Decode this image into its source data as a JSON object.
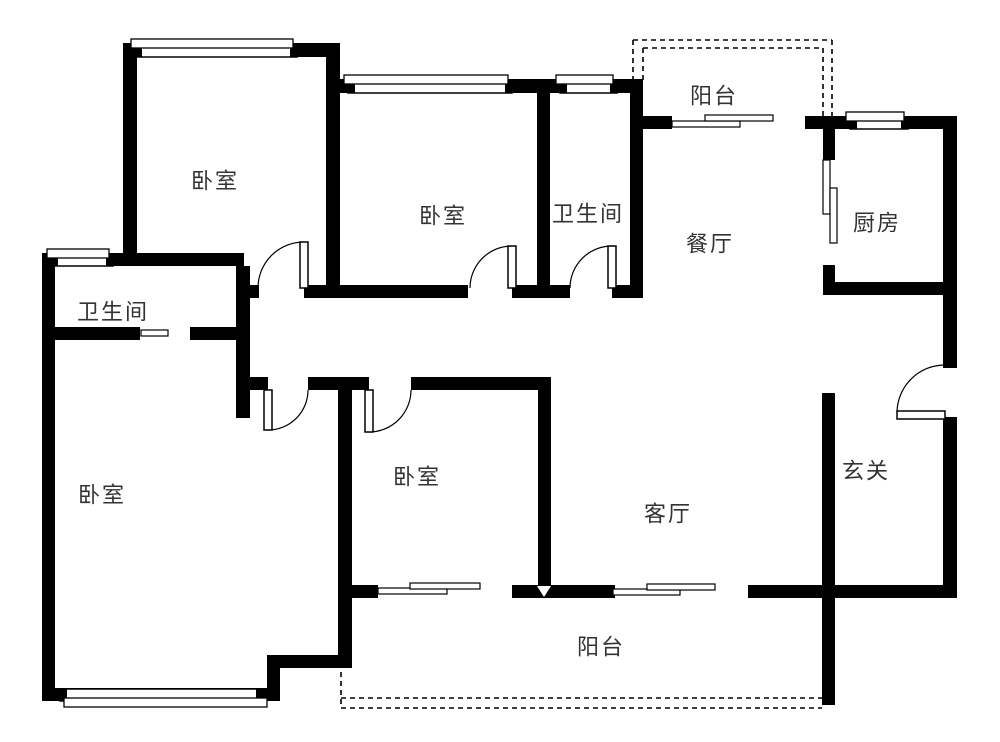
{
  "canvas": {
    "width": 1000,
    "height": 742,
    "bg": "#ffffff",
    "wall_color": "#000000",
    "line_color": "#000000",
    "label_color": "#333333",
    "label_font_size": 22,
    "label_letter_spacing": 2
  },
  "rooms": [
    {
      "id": "bedroom-top-left",
      "label": "卧室",
      "cx": 215,
      "cy": 181
    },
    {
      "id": "bedroom-top-middle",
      "label": "卧室",
      "cx": 443,
      "cy": 216
    },
    {
      "id": "bathroom-top",
      "label": "卫生间",
      "cx": 588,
      "cy": 214
    },
    {
      "id": "balcony-top",
      "label": "阳台",
      "cx": 714,
      "cy": 96
    },
    {
      "id": "dining-room",
      "label": "餐厅",
      "cx": 710,
      "cy": 244
    },
    {
      "id": "kitchen",
      "label": "厨房",
      "cx": 877,
      "cy": 223
    },
    {
      "id": "bathroom-left",
      "label": "卫生间",
      "cx": 113,
      "cy": 312
    },
    {
      "id": "bedroom-master",
      "label": "卧室",
      "cx": 102,
      "cy": 495
    },
    {
      "id": "bedroom-bottom-middle",
      "label": "卧室",
      "cx": 417,
      "cy": 477
    },
    {
      "id": "living-room",
      "label": "客厅",
      "cx": 668,
      "cy": 514
    },
    {
      "id": "entry-hall",
      "label": "玄关",
      "cx": 866,
      "cy": 471
    },
    {
      "id": "balcony-bottom",
      "label": "阳台",
      "cx": 601,
      "cy": 647
    }
  ],
  "walls": [
    [
      123,
      43,
      217,
      14
    ],
    [
      123,
      43,
      14,
      223
    ],
    [
      42,
      253,
      202,
      13
    ],
    [
      42,
      253,
      13,
      448
    ],
    [
      50,
      327,
      90,
      13
    ],
    [
      190,
      327,
      60,
      13
    ],
    [
      236,
      266,
      14,
      152
    ],
    [
      249,
      285,
      10,
      13
    ],
    [
      304,
      285,
      164,
      13
    ],
    [
      512,
      285,
      58,
      13
    ],
    [
      612,
      285,
      31,
      13
    ],
    [
      326,
      43,
      14,
      254
    ],
    [
      340,
      79,
      210,
      14
    ],
    [
      537,
      93,
      13,
      204
    ],
    [
      550,
      79,
      93,
      14
    ],
    [
      630,
      79,
      13,
      219
    ],
    [
      630,
      116,
      42,
      13
    ],
    [
      805,
      116,
      30,
      13
    ],
    [
      823,
      116,
      134,
      13
    ],
    [
      823,
      116,
      12,
      44
    ],
    [
      823,
      265,
      12,
      30
    ],
    [
      823,
      282,
      134,
      13
    ],
    [
      943,
      116,
      14,
      252
    ],
    [
      943,
      417,
      14,
      181
    ],
    [
      822,
      393,
      13,
      312
    ],
    [
      236,
      377,
      32,
      13
    ],
    [
      308,
      377,
      61,
      13
    ],
    [
      411,
      377,
      140,
      13
    ],
    [
      338,
      377,
      14,
      286
    ],
    [
      538,
      377,
      13,
      220
    ],
    [
      338,
      585,
      40,
      13
    ],
    [
      512,
      585,
      103,
      13
    ],
    [
      748,
      585,
      207,
      13
    ],
    [
      42,
      688,
      238,
      13
    ],
    [
      267,
      657,
      13,
      44
    ],
    [
      267,
      655,
      85,
      13
    ]
  ],
  "windows": [
    {
      "id": "window-bedroom-top-left",
      "main": [
        135,
        44,
        162,
        13
      ],
      "outer": [
        131,
        39,
        162,
        9
      ]
    },
    {
      "id": "window-bathroom-left",
      "main": [
        51,
        254,
        62,
        12
      ],
      "outer": [
        47,
        249,
        62,
        9
      ]
    },
    {
      "id": "window-bedroom-top-middle",
      "main": [
        348,
        80,
        164,
        13
      ],
      "outer": [
        344,
        75,
        164,
        9
      ]
    },
    {
      "id": "window-bathroom-top",
      "main": [
        560,
        80,
        57,
        13
      ],
      "outer": [
        556,
        75,
        57,
        9
      ]
    },
    {
      "id": "window-kitchen",
      "main": [
        850,
        117,
        58,
        12
      ],
      "outer": [
        846,
        112,
        58,
        9
      ]
    },
    {
      "id": "window-bedroom-master",
      "main": [
        60,
        689,
        203,
        12
      ],
      "outer": [
        64,
        698,
        203,
        9
      ]
    }
  ],
  "doors": [
    {
      "id": "door-bedroom-top-left",
      "arc": "M258,288 A46,46 0 0 1 304,242",
      "leaf": [
        300,
        242,
        8,
        46
      ]
    },
    {
      "id": "door-bedroom-top-middle",
      "arc": "M470,288 A42,42 0 0 1 512,246",
      "leaf": [
        508,
        246,
        8,
        42
      ]
    },
    {
      "id": "door-bathroom-top",
      "arc": "M570,288 A42,42 0 0 1 612,246",
      "leaf": [
        608,
        246,
        8,
        42
      ]
    },
    {
      "id": "door-bedroom-master",
      "arc": "M268,430 A40,40 0 0 0 308,390",
      "leaf": [
        264,
        390,
        8,
        40
      ]
    },
    {
      "id": "door-bedroom-bottom-middle",
      "arc": "M369,432 A42,42 0 0 0 411,390",
      "leaf": [
        365,
        390,
        8,
        42
      ]
    },
    {
      "id": "door-entry",
      "arc": "M897,413 A48,48 0 0 1 945,365",
      "leaf": [
        897,
        411,
        48,
        8
      ]
    }
  ],
  "sliding_panels": [
    {
      "id": "slider-bedroom-balcony-a",
      "rect": [
        378,
        588,
        69,
        6
      ]
    },
    {
      "id": "slider-bedroom-balcony-b",
      "rect": [
        410,
        583,
        70,
        6
      ]
    },
    {
      "id": "slider-living-balcony-a",
      "rect": [
        613,
        589,
        67,
        6
      ]
    },
    {
      "id": "slider-living-balcony-b",
      "rect": [
        647,
        584,
        68,
        6
      ]
    },
    {
      "id": "slider-dining-balcony-a",
      "rect": [
        672,
        121,
        68,
        6
      ]
    },
    {
      "id": "slider-dining-balcony-b",
      "rect": [
        705,
        115,
        68,
        6
      ]
    },
    {
      "id": "slider-kitchen-a",
      "rect": [
        823,
        160,
        7,
        54
      ]
    },
    {
      "id": "slider-kitchen-b",
      "rect": [
        830,
        188,
        7,
        55
      ]
    },
    {
      "id": "slider-bathroom-left",
      "rect": [
        141,
        330,
        27,
        6
      ]
    }
  ],
  "dashed_lines": [
    {
      "id": "balcony-top-outer-h",
      "pts": [
        633,
        40,
        832,
        40
      ]
    },
    {
      "id": "balcony-top-inner-h",
      "pts": [
        643,
        48,
        823,
        48
      ]
    },
    {
      "id": "balcony-top-outer-vl",
      "pts": [
        633,
        40,
        633,
        80
      ]
    },
    {
      "id": "balcony-top-inner-vl",
      "pts": [
        643,
        48,
        643,
        80
      ]
    },
    {
      "id": "balcony-top-outer-vr",
      "pts": [
        832,
        40,
        832,
        116
      ]
    },
    {
      "id": "balcony-top-inner-vr",
      "pts": [
        823,
        48,
        823,
        116
      ]
    },
    {
      "id": "balcony-bottom-v",
      "pts": [
        341,
        663,
        341,
        708
      ]
    },
    {
      "id": "balcony-bottom-inner",
      "pts": [
        341,
        698,
        822,
        698
      ]
    },
    {
      "id": "balcony-bottom-outer",
      "pts": [
        341,
        708,
        822,
        708
      ]
    }
  ],
  "markers": [
    {
      "id": "wall-triangle-marker",
      "points": "537,586 551,586 544,597",
      "fill": "#ffffff"
    }
  ]
}
